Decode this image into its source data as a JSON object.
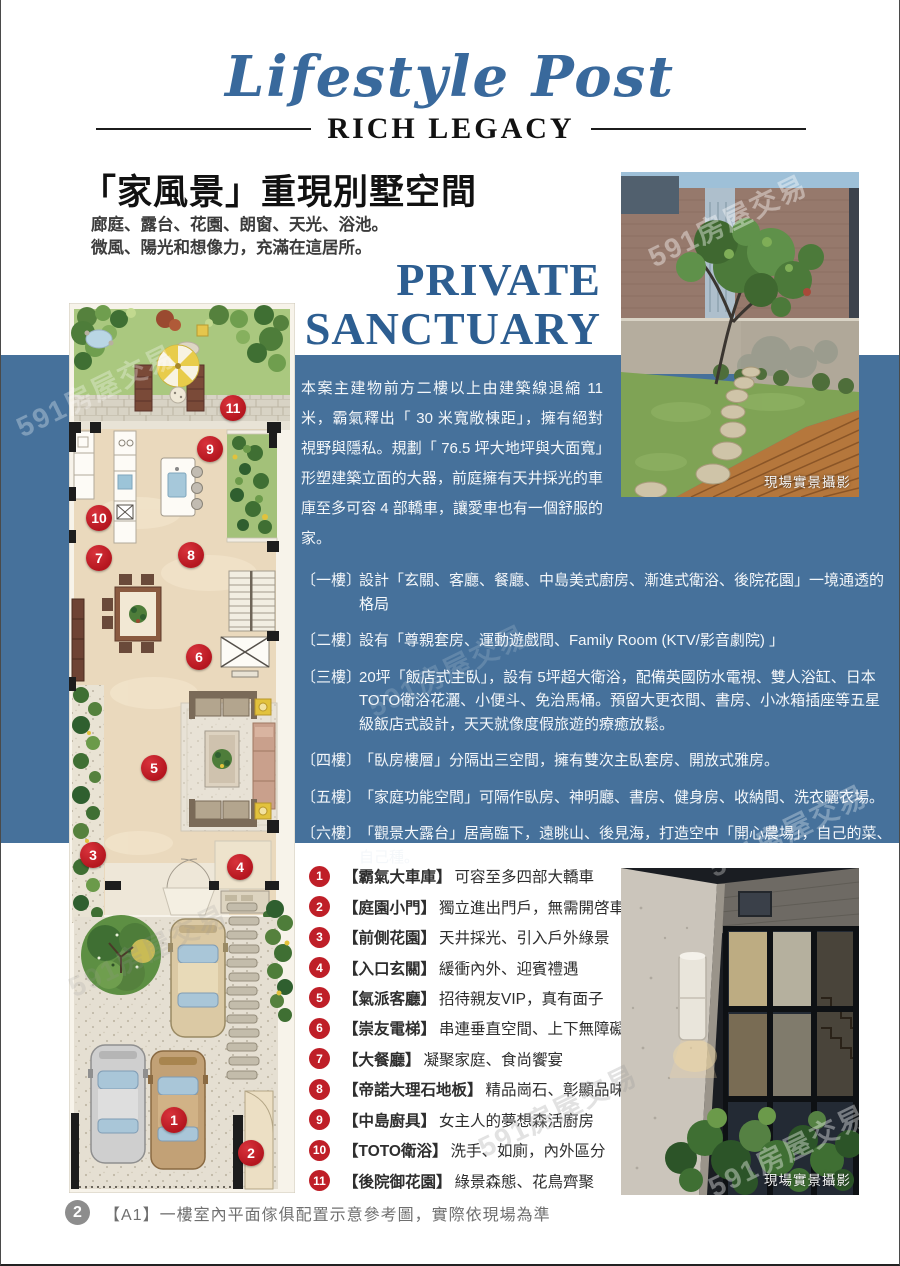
{
  "header": {
    "script_title": "Lifestyle Post",
    "sub_title": "RICH LEGACY"
  },
  "intro": {
    "title": "「家風景」重現別墅空間",
    "subtitle_line1": "廊庭、露台、花園、朗窗、天光、浴池。",
    "subtitle_line2": "微風、陽光和想像力，充滿在這居所。",
    "english_line1": "PRIVATE",
    "english_line2": "SANCTUARY"
  },
  "description": "本案主建物前方二樓以上由建築線退縮 11 米，霸氣釋出「 30 米寬敞棟距」，擁有絕對視野與隱私。規劃「 76.5 坪大地坪與大面寬」形塑建築立面的大器，前庭擁有天井採光的車庫至多可容 4 部轎車，讓愛車也有一個舒服的家。",
  "floors": [
    {
      "label": "〔一樓〕",
      "text": "設計「玄關、客廳、餐廳、中島美式廚房、漸進式衛浴、後院花園」一境通透的格局"
    },
    {
      "label": "〔二樓〕",
      "text": "設有「尊親套房、運動遊戲間、Family Room (KTV/影音劇院) 」"
    },
    {
      "label": "〔三樓〕",
      "text": "20坪「飯店式主臥」，設有 5坪超大衛浴，配備英國防水電視、雙人浴缸、日本TOTO衛浴花灑、小便斗、免治馬桶。預留大更衣間、書房、小冰箱插座等五星級飯店式設計，天天就像度假旅遊的療癒放鬆。"
    },
    {
      "label": "〔四樓〕",
      "text": "「臥房樓層」分隔出三空間，擁有雙次主臥套房、開放式雅房。"
    },
    {
      "label": "〔五樓〕",
      "text": "「家庭功能空間」可隔作臥房、神明廳、書房、健身房、收納間、洗衣曬衣場。"
    },
    {
      "label": "〔六樓〕",
      "text": "「觀景大露台」居高臨下，遠眺山、後見海，打造空中「開心農場」，自己的菜、自己種。"
    }
  ],
  "legend": {
    "items": [
      {
        "num": "1",
        "title": "【霸氣大車庫】",
        "desc": "可容至多四部大轎車"
      },
      {
        "num": "2",
        "title": "【庭園小門】",
        "desc": "獨立進出門戶，無需開啓車庫門"
      },
      {
        "num": "3",
        "title": "【前側花園】",
        "desc": "天井採光、引入戶外綠景"
      },
      {
        "num": "4",
        "title": "【入口玄關】",
        "desc": "緩衝內外、迎賓禮遇"
      },
      {
        "num": "5",
        "title": "【氣派客廳】",
        "desc": "招待親友VIP，真有面子"
      },
      {
        "num": "6",
        "title": "【崇友電梯】",
        "desc": "串連垂直空間、上下無障礙"
      },
      {
        "num": "7",
        "title": "【大餐廳】",
        "desc": "凝聚家庭、食尚饗宴"
      },
      {
        "num": "8",
        "title": "【帝諾大理石地板】",
        "desc": "精品崗石、彰顯品味"
      },
      {
        "num": "9",
        "title": "【中島廚具】",
        "desc": "女主人的夢想森活廚房"
      },
      {
        "num": "10",
        "title": "【TOTO衛浴】",
        "desc": "洗手、如廁，內外區分"
      },
      {
        "num": "11",
        "title": "【後院御花園】",
        "desc": "綠景森態、花鳥齊聚"
      }
    ]
  },
  "plan": {
    "markers": [
      "1",
      "2",
      "3",
      "4",
      "5",
      "6",
      "7",
      "8",
      "9",
      "10",
      "11"
    ]
  },
  "photos": {
    "top_caption": "現場實景攝影",
    "bottom_caption": "現場實景攝影"
  },
  "footer": {
    "num": "2",
    "text": "【A1】一樓室內平面傢俱配置示意參考圖，實際依現場為準"
  },
  "watermark": "591房屋交易",
  "colors": {
    "band": "#46719b",
    "accent_red": "#bf1f28",
    "heading_blue": "#2d5e91"
  }
}
